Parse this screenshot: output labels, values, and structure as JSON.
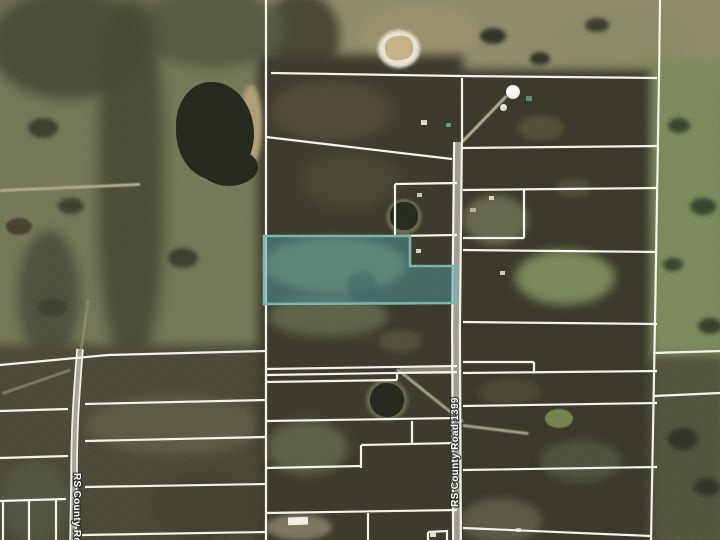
{
  "map": {
    "description": "aerial-parcel-map",
    "line_color": "#f3f3ee",
    "line_width": 2.2,
    "highlighted_parcel": {
      "points": "264,236 410,236 410,266 456,266 456,303 264,304",
      "fill": "rgba(84,153,158,0.50)",
      "stroke": "#7fb3b0",
      "stroke_width": 2.6
    },
    "roads": [
      {
        "name": "rs-county-road-1399",
        "d": "M 458,142 L 456,330 L 457,540",
        "casing_width": 10,
        "fill_width": 5.5,
        "casing_color": "#f1f1ec",
        "fill_color": "#a19c92"
      },
      {
        "name": "rs-county-road-west",
        "d": "M 80,349 C 76,400 74,430 74,482 L 73,540",
        "casing_width": 7.5,
        "fill_width": 4,
        "casing_color": "#f1f1ec",
        "fill_color": "#a8a499"
      }
    ],
    "road_labels": [
      {
        "text": "RS County Road 1399",
        "x": 458,
        "y": 452,
        "rotation": -90,
        "anchor": "middle",
        "font_size": 10
      },
      {
        "text": "RS County Road",
        "x": 74,
        "y": 473,
        "rotation": 90,
        "anchor": "start",
        "font_size": 10
      }
    ],
    "parcel_lines": [
      "266,0 266,540",
      "271,73 460,76 657,78",
      "660,0 659,77 655,322 651,540",
      "462,78 462,142",
      "266,137 452,159",
      "395,184 457,183",
      "395,184 395,236",
      "395,236 457,235",
      "266,369 457,366",
      "266,375 457,372",
      "266,382 397,380",
      "397,380 397,372",
      "266,421 457,418",
      "412,421 412,444",
      "361,445 457,443",
      "361,445 361,468",
      "266,468 361,466",
      "266,513 457,510",
      "368,513 368,540",
      "428,532 428,540",
      "428,532 447,531 447,540",
      "463,148 657,146",
      "463,190 657,188",
      "524,190 524,238",
      "463,238 524,238",
      "463,250 657,252",
      "463,322 657,324",
      "463,362 534,362",
      "534,362 534,372",
      "463,373 657,371",
      "463,406 657,403",
      "463,470 657,467",
      "463,528 651,536",
      "653,353 720,351",
      "654,396 720,393",
      "0,365 108,355 266,351",
      "85,404 266,400",
      "85,441 266,437",
      "85,487 266,484",
      "82,535 266,532",
      "0,411 68,409",
      "0,458 68,456",
      "0,501 66,499",
      "3,501 3,540",
      "29,500 29,540",
      "56,500 56,540"
    ]
  }
}
